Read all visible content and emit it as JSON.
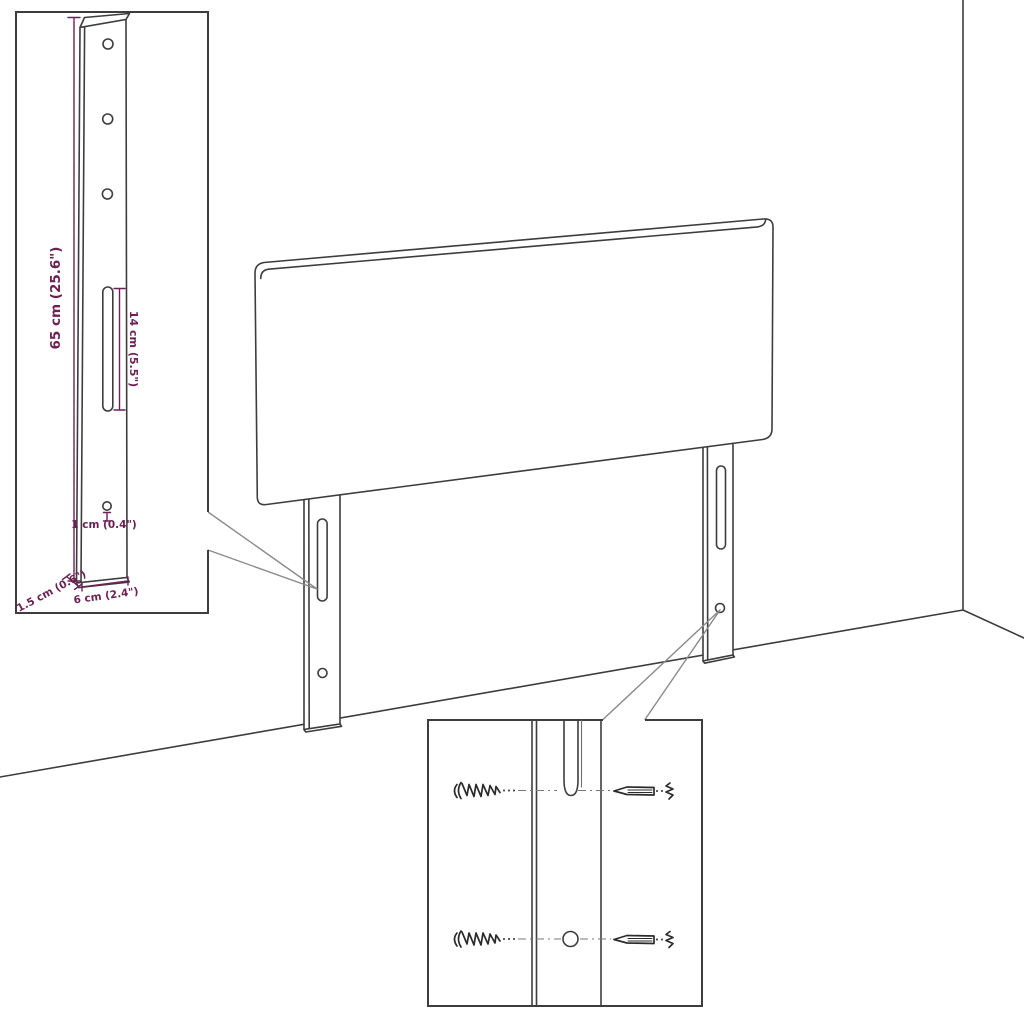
{
  "page": {
    "background": "#ffffff"
  },
  "drawing": {
    "subject": "headboard-with-mounting-legs",
    "line_color": "#3d3d3d",
    "dimension_color": "#6d2155",
    "dimensions": {
      "bracket_height": "65 cm (25.6\")",
      "slot_length": "14 cm (5.5\")",
      "hole_diameter": "1 cm (0.4\")",
      "bracket_thickness": "1.5 cm (0.6\")",
      "bracket_width": "6 cm (2.4\")"
    },
    "icons": [
      "wood-screw-icon",
      "wall-plug-screw-icon",
      "mounting-slot",
      "mounting-hole"
    ]
  }
}
